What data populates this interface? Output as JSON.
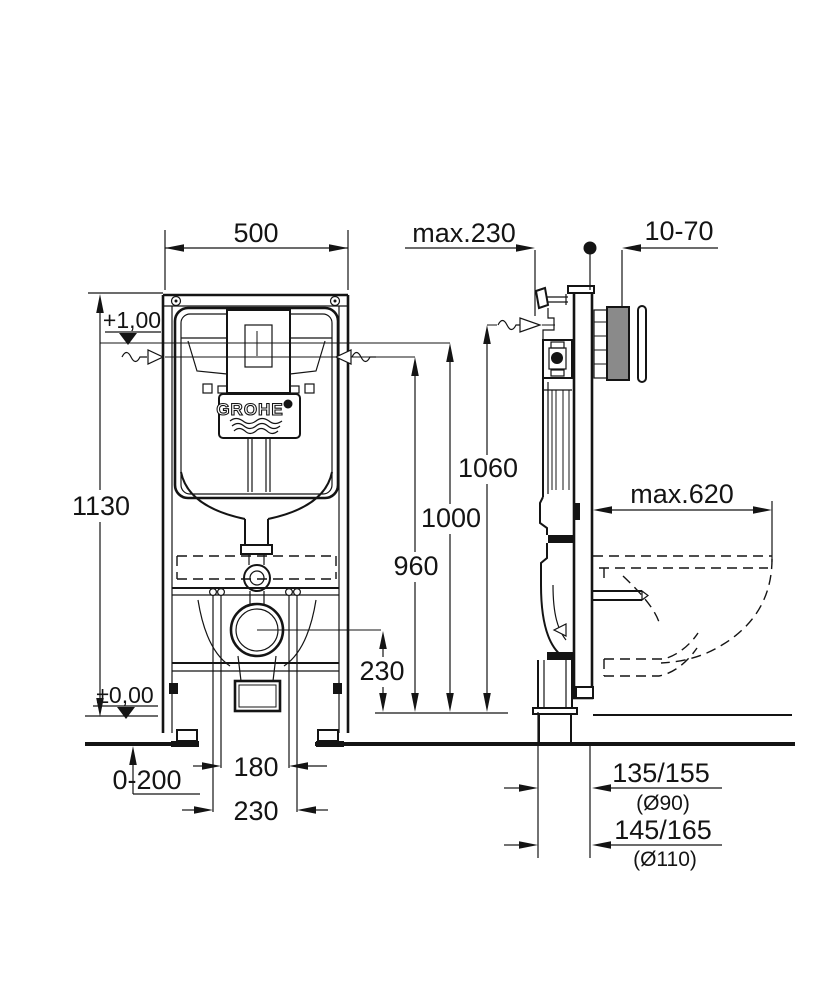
{
  "brand": {
    "logo": "GROHE"
  },
  "front": {
    "width": "500",
    "frame_height": "1130",
    "upper_level": "+1,00",
    "floor_level": "±0,00",
    "floor_buildup": "0-200",
    "rod_spacing": "180",
    "outlet_offset": "230",
    "outlet_height": "230",
    "level_960": "960",
    "level_1000": "1000",
    "level_1060": "1060"
  },
  "side": {
    "frame_depth": "max.230",
    "wall_finish_range": "10-70",
    "bowl_depth_max": "max.620",
    "outlet_90": "135/155",
    "outlet_90_dia": "(Ø90)",
    "outlet_110": "145/165",
    "outlet_110_dia": "(Ø110)"
  },
  "colors": {
    "line": "#141414",
    "background": "#ffffff"
  }
}
